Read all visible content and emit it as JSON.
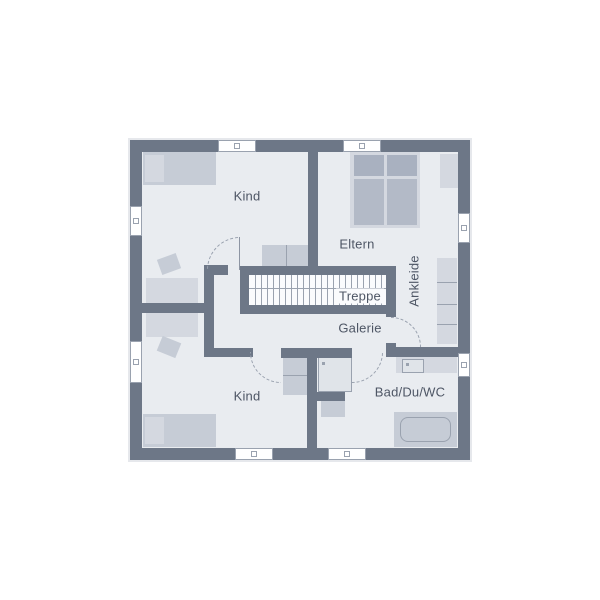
{
  "labels": {
    "kind_top": "Kind",
    "eltern": "Eltern",
    "treppe": "Treppe",
    "galerie": "Galerie",
    "ankleide": "Ankleide",
    "kind_bottom": "Kind",
    "bad": "Bad/Du/WC"
  },
  "colors": {
    "wall": "#6d7787",
    "floor": "#e9ecf0",
    "white": "#ffffff",
    "furniture_mid": "#c6ccd6",
    "furniture_light": "#d4d8e0",
    "pillow_dark": "#a9b1c0",
    "mattress": "#b3bac7",
    "line": "#9aa2af",
    "leaf": "#8d95a3",
    "text": "#4e5665",
    "stair_bg": "#fafbfd",
    "shower": "#e0e4e9",
    "arrow": "#454c5a",
    "halo": "#e6e8ec"
  },
  "floorplan": {
    "base": [
      130,
      140,
      340,
      320
    ],
    "walls": [
      [
        130,
        140,
        340,
        12
      ],
      [
        130,
        448,
        340,
        12
      ],
      [
        130,
        140,
        12,
        320
      ],
      [
        458,
        140,
        12,
        320
      ],
      [
        308,
        152,
        10,
        114
      ],
      [
        240,
        266,
        156,
        9
      ],
      [
        248,
        305,
        148,
        9
      ],
      [
        240,
        266,
        9,
        48
      ],
      [
        386,
        266,
        10,
        51
      ],
      [
        204,
        265,
        10,
        92
      ],
      [
        204,
        265,
        24,
        10
      ],
      [
        142,
        303,
        72,
        10
      ],
      [
        204,
        348,
        49,
        9
      ],
      [
        281,
        348,
        71,
        10
      ],
      [
        307,
        357,
        10,
        91
      ],
      [
        317,
        392,
        28,
        9
      ],
      [
        386,
        343,
        10,
        14
      ],
      [
        396,
        347,
        62,
        10
      ]
    ],
    "windows": [
      [
        218,
        140,
        38,
        12
      ],
      [
        343,
        140,
        38,
        12
      ],
      [
        235,
        448,
        38,
        12
      ],
      [
        328,
        448,
        38,
        12
      ],
      [
        130,
        206,
        12,
        30
      ],
      [
        130,
        341,
        12,
        42
      ],
      [
        458,
        213,
        12,
        30
      ],
      [
        458,
        353,
        12,
        24
      ]
    ],
    "furniture": [
      {
        "n": "bed",
        "x": 143,
        "y": 152,
        "w": 73,
        "h": 33,
        "c": "furniture_mid"
      },
      {
        "n": "bed-pillow",
        "x": 145,
        "y": 155,
        "w": 19,
        "h": 27,
        "c": "furniture_light"
      },
      {
        "n": "desk",
        "x": 146,
        "y": 278,
        "w": 52,
        "h": 25,
        "c": "furniture_light"
      },
      {
        "n": "chair",
        "x": 159,
        "y": 256,
        "w": 20,
        "h": 16,
        "c": "furniture_mid",
        "rot": -20
      },
      {
        "n": "desk",
        "x": 146,
        "y": 312,
        "w": 52,
        "h": 25,
        "c": "furniture_light"
      },
      {
        "n": "chair",
        "x": 159,
        "y": 339,
        "w": 20,
        "h": 16,
        "c": "furniture_mid",
        "rot": 22
      },
      {
        "n": "bed",
        "x": 143,
        "y": 414,
        "w": 73,
        "h": 33,
        "c": "furniture_mid"
      },
      {
        "n": "bed-pillow",
        "x": 145,
        "y": 417,
        "w": 19,
        "h": 27,
        "c": "furniture_light"
      },
      {
        "n": "sideboard",
        "x": 262,
        "y": 245,
        "w": 47,
        "h": 21,
        "c": "furniture_mid"
      },
      {
        "n": "sideboard-line",
        "x": 286,
        "y": 245,
        "w": 1,
        "h": 21,
        "c": "line"
      },
      {
        "n": "double-bed-frame",
        "x": 350,
        "y": 152,
        "w": 70,
        "h": 76,
        "c": "furniture_light"
      },
      {
        "n": "double-bed-pillow",
        "x": 354,
        "y": 155,
        "w": 30,
        "h": 21,
        "c": "pillow_dark"
      },
      {
        "n": "double-bed-pillow",
        "x": 387,
        "y": 155,
        "w": 30,
        "h": 21,
        "c": "pillow_dark"
      },
      {
        "n": "double-bed-mattress",
        "x": 354,
        "y": 179,
        "w": 30,
        "h": 46,
        "c": "mattress"
      },
      {
        "n": "double-bed-mattress",
        "x": 387,
        "y": 179,
        "w": 30,
        "h": 46,
        "c": "mattress"
      },
      {
        "n": "nightstand",
        "x": 440,
        "y": 154,
        "w": 18,
        "h": 34,
        "c": "furniture_light"
      },
      {
        "n": "wardrobe",
        "x": 437,
        "y": 258,
        "w": 20,
        "h": 86,
        "c": "furniture_light"
      },
      {
        "n": "wardrobe-line",
        "x": 437,
        "y": 282,
        "w": 20,
        "h": 1,
        "c": "line"
      },
      {
        "n": "wardrobe-line",
        "x": 437,
        "y": 304,
        "w": 20,
        "h": 1,
        "c": "line"
      },
      {
        "n": "wardrobe-line",
        "x": 437,
        "y": 324,
        "w": 20,
        "h": 1,
        "c": "line"
      },
      {
        "n": "wardrobe",
        "x": 283,
        "y": 357,
        "w": 24,
        "h": 38,
        "c": "furniture_mid"
      },
      {
        "n": "wardrobe-line",
        "x": 283,
        "y": 375,
        "w": 24,
        "h": 1,
        "c": "line"
      },
      {
        "n": "vanity",
        "x": 396,
        "y": 357,
        "w": 61,
        "h": 16,
        "c": "furniture_light"
      },
      {
        "n": "washbasin",
        "x": 402,
        "y": 359,
        "w": 22,
        "h": 14,
        "c": "shower",
        "b": "line"
      },
      {
        "n": "washbasin-dot",
        "x": 406,
        "y": 363,
        "w": 3,
        "h": 3,
        "c": "line"
      },
      {
        "n": "shower",
        "x": 318,
        "y": 357,
        "w": 34,
        "h": 35,
        "c": "shower",
        "b": "line"
      },
      {
        "n": "shower-dot",
        "x": 322,
        "y": 362,
        "w": 3,
        "h": 3,
        "c": "line"
      },
      {
        "n": "wc",
        "x": 321,
        "y": 401,
        "w": 24,
        "h": 16,
        "c": "furniture_mid"
      },
      {
        "n": "bathtub",
        "x": 394,
        "y": 412,
        "w": 63,
        "h": 35,
        "c": "furniture_mid"
      },
      {
        "n": "bathtub-inner",
        "x": 400,
        "y": 417,
        "w": 51,
        "h": 25,
        "c": "",
        "b": "line",
        "r": 8
      }
    ],
    "stairs": {
      "x": 249,
      "y": 274,
      "w": 137,
      "h": 31,
      "step_start": 255,
      "step_end": 381,
      "step_gap": 6,
      "mid_y": 288,
      "arrow_x": 240,
      "arrow_y": 284
    },
    "doors": [
      {
        "n": "door-arc-kind-top",
        "cx": 240,
        "cy": 270,
        "r": 33,
        "qx": -1,
        "qy": -1
      },
      {
        "n": "door-arc-kind-bottom",
        "cx": 281,
        "cy": 352,
        "r": 31,
        "qx": -1,
        "qy": 1
      },
      {
        "n": "door-arc-bad",
        "cx": 352,
        "cy": 352,
        "r": 31,
        "qx": 1,
        "qy": 1
      },
      {
        "n": "door-arc-ankleide",
        "cx": 391,
        "cy": 347,
        "r": 30,
        "qx": 1,
        "qy": -1
      }
    ],
    "leaves": [
      {
        "n": "door-leaf",
        "x": 239,
        "y": 237,
        "w": 1,
        "h": 33
      }
    ]
  }
}
